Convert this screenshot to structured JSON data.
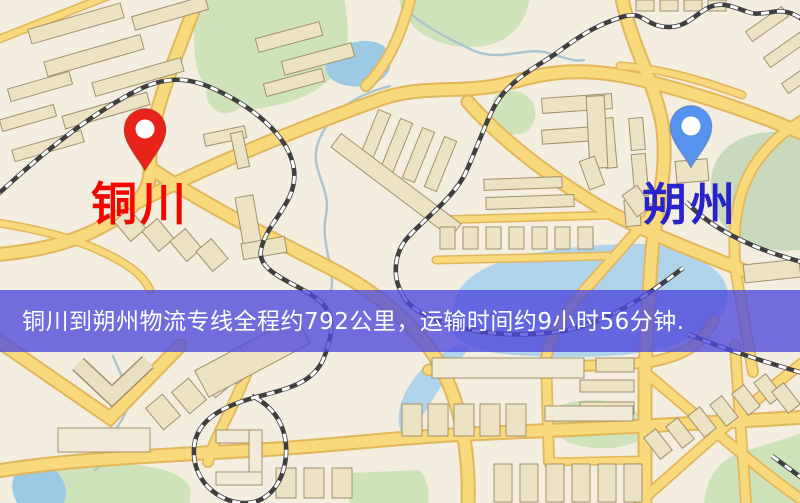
{
  "banner": {
    "text": "铜川到朔州物流专线全程约792公里，运输时间约9小时56分钟.",
    "background": "#4d49dd",
    "text_color": "#ffffff"
  },
  "markers": {
    "origin": {
      "label": "铜川",
      "pin_color": "#e8231a",
      "label_color": "#f50400"
    },
    "destination": {
      "label": "朔州",
      "pin_color": "#5593ee",
      "label_color": "#2823cc"
    }
  },
  "map": {
    "background": "#f3eee0",
    "road_color": "#f8d97b",
    "water_color": "#9cc9e4",
    "park_color": "#cfe3bb",
    "railway_color": "#3f3f3f",
    "building_color": "#ece3c4"
  }
}
